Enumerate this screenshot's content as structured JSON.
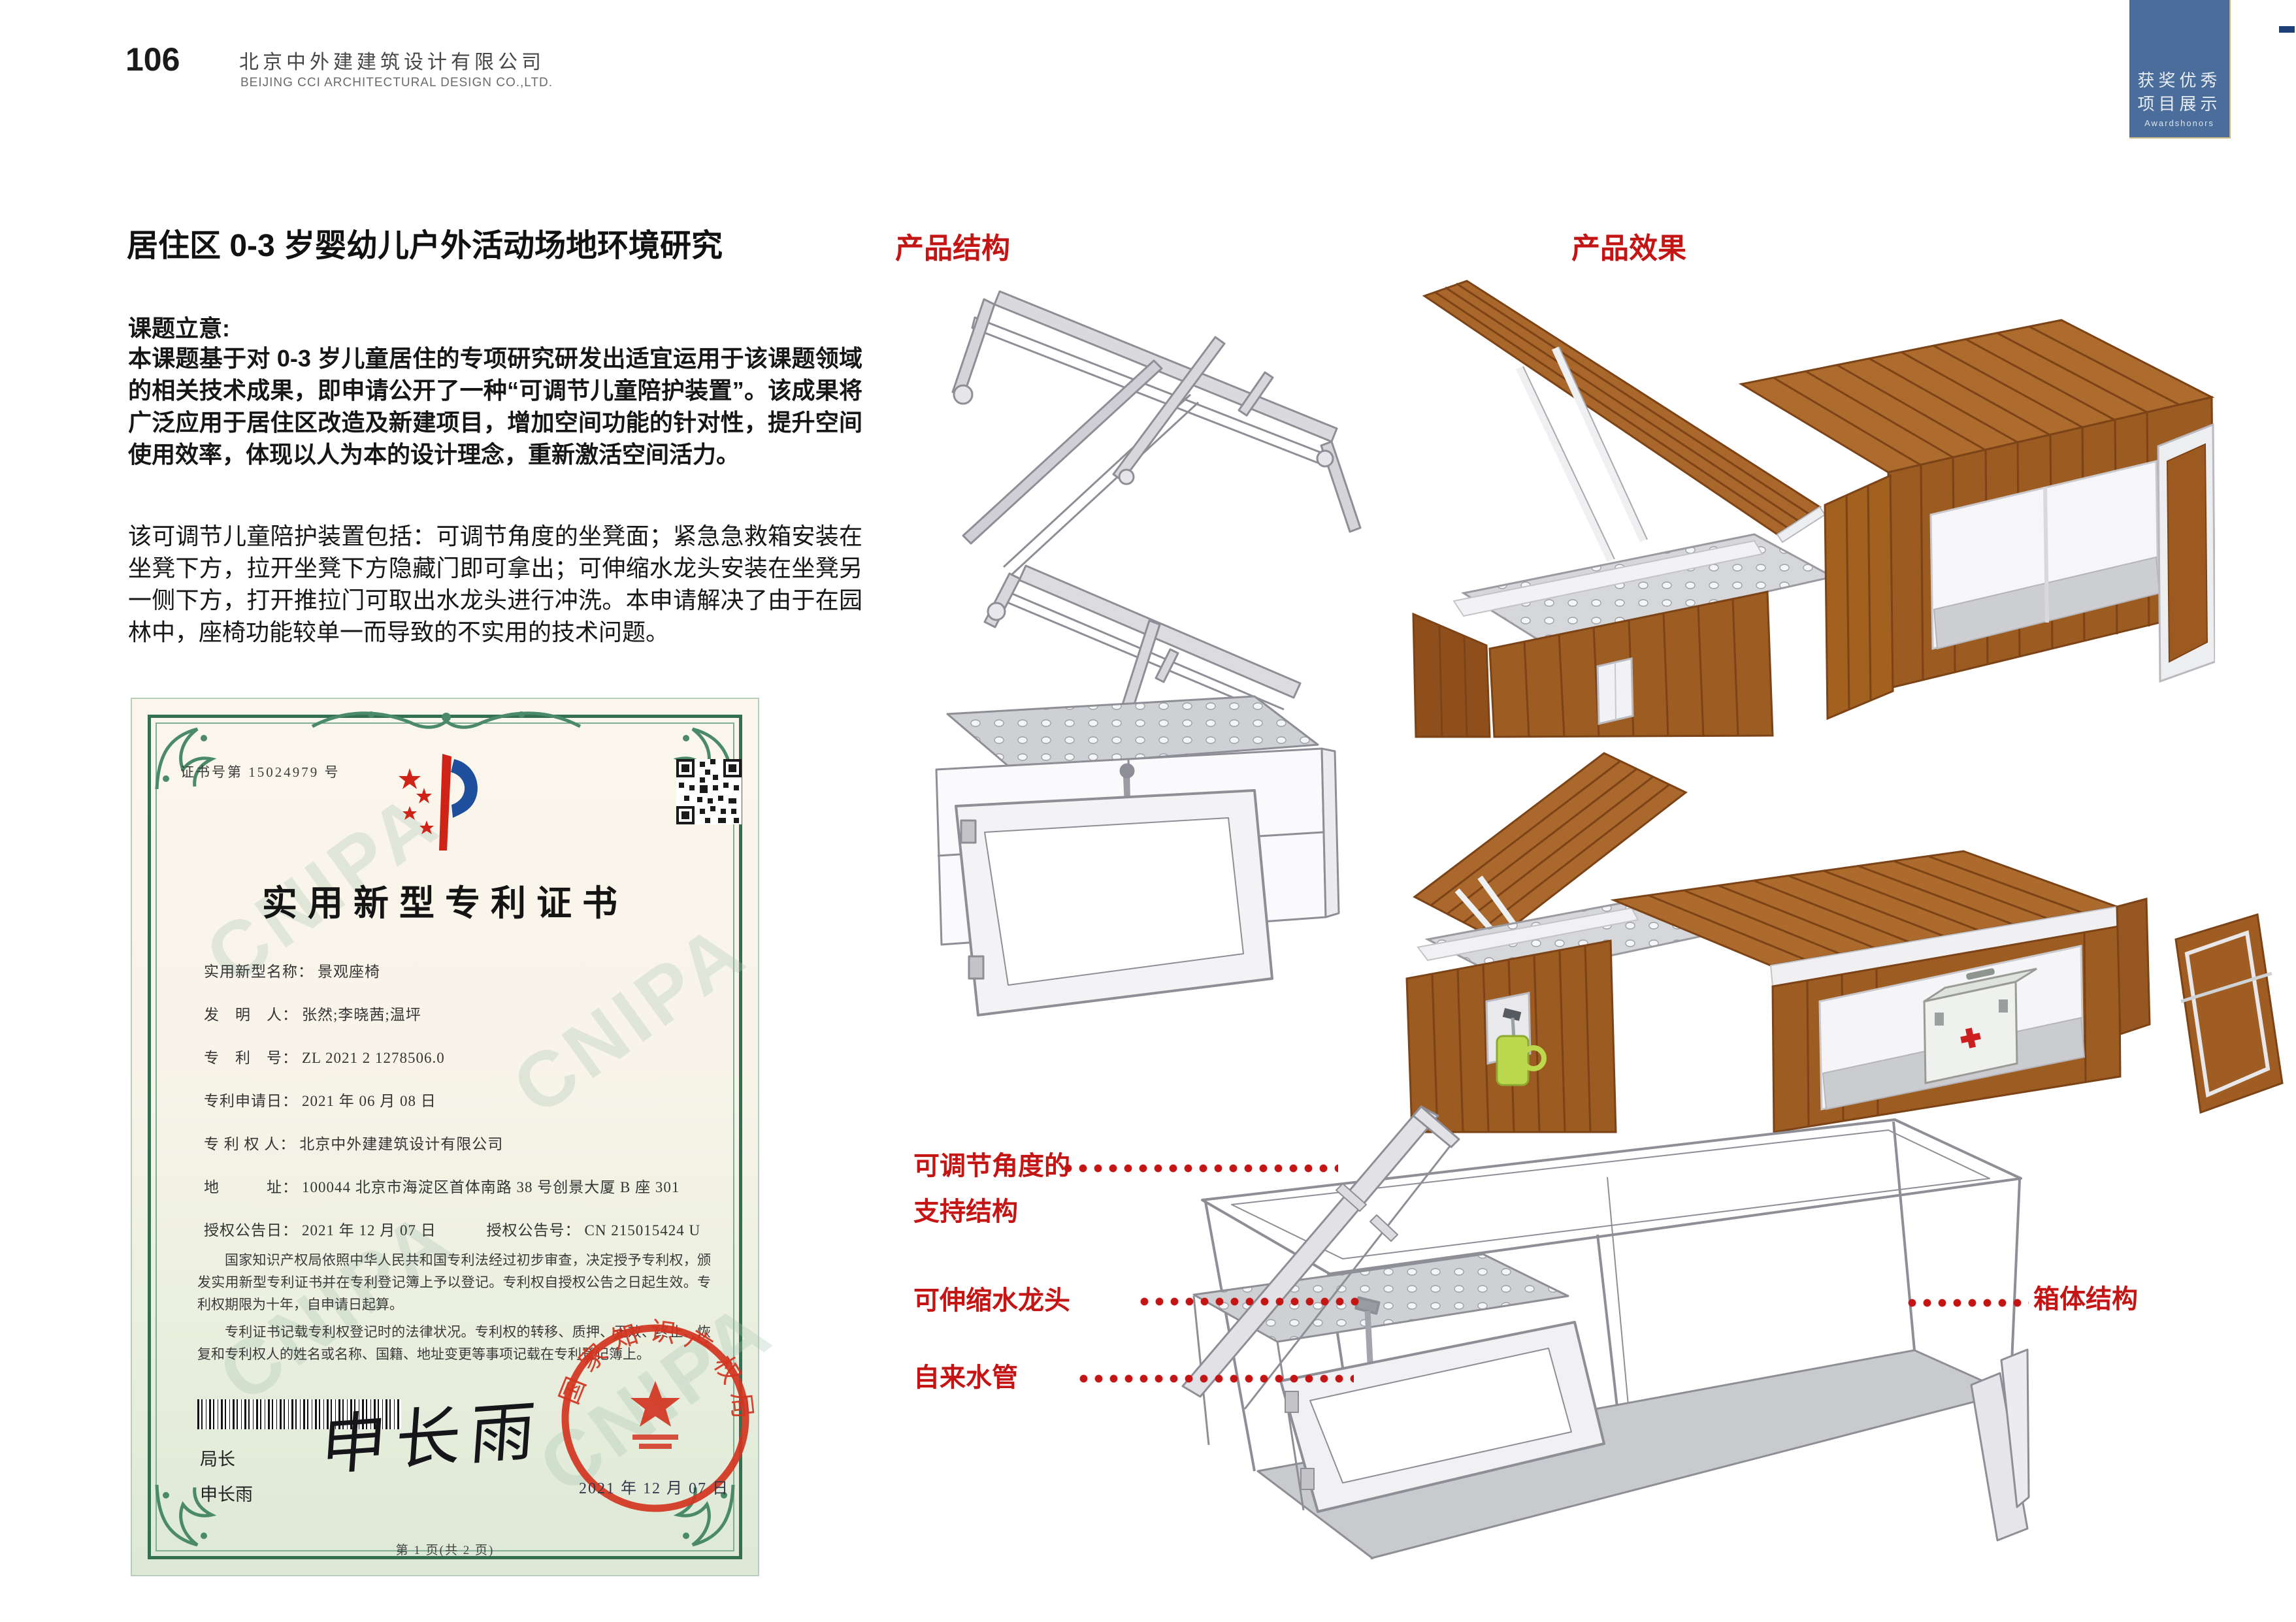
{
  "palette": {
    "accent_red": "#c51414",
    "tab_blue": "#4a6d9b",
    "wood_brown": "#a8662c",
    "seal_red": "#d23420",
    "cert_green": "#336f51"
  },
  "page": {
    "number": "106",
    "company_cn": "北京中外建建筑设计有限公司",
    "company_en": "BEIJING CCI ARCHITECTURAL DESIGN CO.,LTD."
  },
  "corner_tab": {
    "line1": "获奖优秀",
    "line2": "项目展示",
    "line3": "Awardshonors"
  },
  "article": {
    "title": "居住区 0-3 岁婴幼儿户外活动场地环境研究",
    "section_heading": "课题立意:",
    "paragraph1": "本课题基于对 0-3 岁儿童居住的专项研究研发出适宜运用于该课题领域的相关技术成果，即申请公开了一种“可调节儿童陪护装置”。该成果将广泛应用于居住区改造及新建项目，增加空间功能的针对性，提升空间使用效率，体现以人为本的设计理念，重新激活空间活力。",
    "paragraph2": "该可调节儿童陪护装置包括：可调节角度的坐凳面；紧急急救箱安装在坐凳下方，拉开坐凳下方隐藏门即可拿出；可伸缩水龙头安装在坐凳另一侧下方，打开推拉门可取出水龙头进行冲洗。本申请解决了由于在园林中，座椅功能较单一而导致的不实用的技术问题。"
  },
  "figures": {
    "structure_label": "产品结构",
    "effect_label": "产品效果"
  },
  "annotations": {
    "support_line1": "可调节角度的",
    "support_line2": "支持结构",
    "faucet": "可伸缩水龙头",
    "pipe": "自来水管",
    "box": "箱体结构"
  },
  "certificate": {
    "cert_no": "证书号第 15024979 号",
    "title": "实用新型专利证书",
    "fields": [
      {
        "label": "实用新型名称：",
        "value": "景观座椅"
      },
      {
        "label": "发　明　人：",
        "value": "张然;李晓茜;温坪"
      },
      {
        "label": "专　利　号：",
        "value": "ZL 2021 2 1278506.0"
      },
      {
        "label": "专利申请日：",
        "value": "2021 年 06 月 08 日"
      },
      {
        "label": "专 利 权 人：",
        "value": "北京中外建建筑设计有限公司"
      },
      {
        "label": "地　　　址：",
        "value": "100044 北京市海淀区首体南路 38 号创景大厦 B 座 301"
      }
    ],
    "grant": {
      "date_label": "授权公告日：",
      "date": "2021 年 12 月 07 日",
      "no_label": "授权公告号：",
      "no": "CN 215015424 U"
    },
    "legal1": "国家知识产权局依照中华人民共和国专利法经过初步审查，决定授予专利权，颁发实用新型专利证书并在专利登记簿上予以登记。专利权自授权公告之日起生效。专利权期限为十年，自申请日起算。",
    "legal2": "专利证书记载专利权登记时的法律状况。专利权的转移、质押、无效、终止、恢复和专利权人的姓名或名称、国籍、地址变更等事项记载在专利登记簿上。",
    "seal_text": "国家知识产权局",
    "seal_date": "2021 年 12 月 07 日",
    "director_label": "局长",
    "director_name": "申长雨",
    "signature": "申长雨",
    "page_info": "第 1 页(共 2 页)",
    "watermark": "CNIPA"
  }
}
